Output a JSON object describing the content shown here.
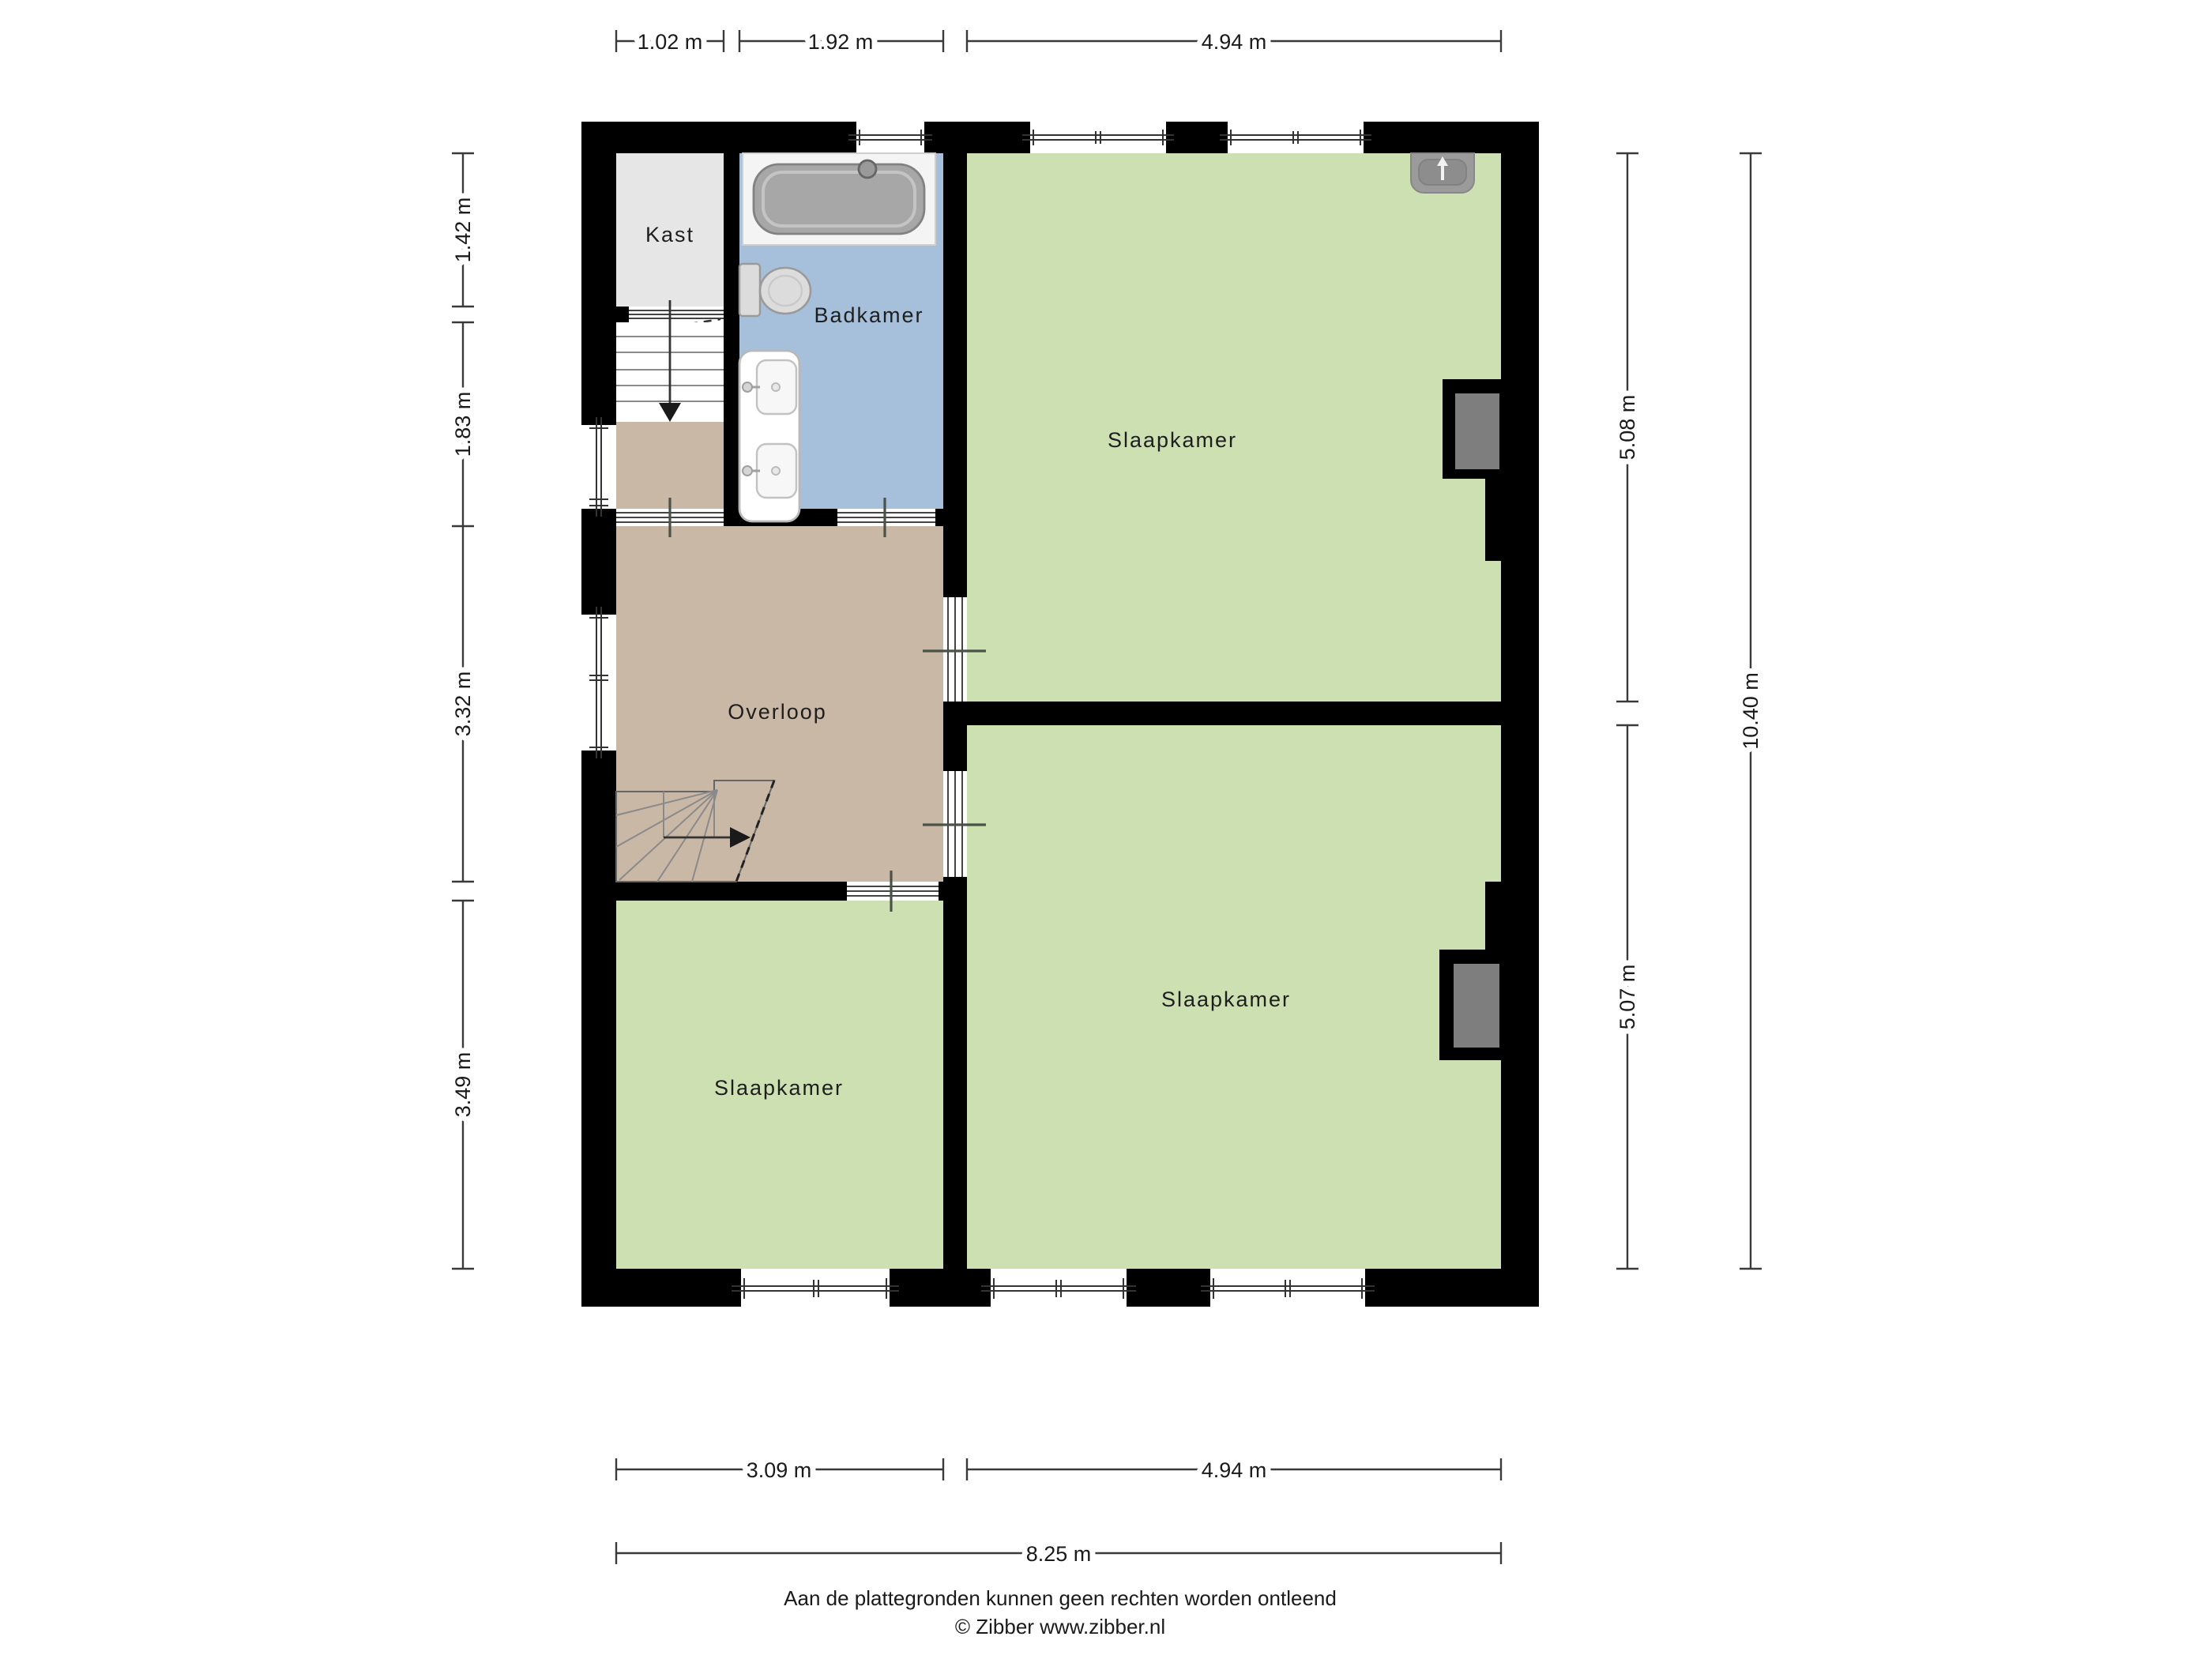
{
  "rooms": {
    "kast": "Kast",
    "badkamer": "Badkamer",
    "overloop": "Overloop",
    "slaapkamer_top": "Slaapkamer",
    "slaapkamer_bottom_right": "Slaapkamer",
    "slaapkamer_bottom_left": "Slaapkamer"
  },
  "dimensions": {
    "top": [
      "1.02 m",
      "1.92 m",
      "4.94 m"
    ],
    "left": [
      "1.42 m",
      "1.83 m",
      "3.32 m",
      "3.49 m"
    ],
    "right": [
      "5.08 m",
      "5.07 m"
    ],
    "right_total": "10.40 m",
    "bottom": [
      "3.09 m",
      "4.94 m"
    ],
    "bottom_total": "8.25 m"
  },
  "footer": {
    "line1": "Aan de plattegronden kunnen geen rechten worden ontleend",
    "line2": "© Zibber www.zibber.nl"
  },
  "colors": {
    "wall": "#000000",
    "room_green": "#cde0b2",
    "bathroom_blue": "#a6c0dc",
    "hall_tan": "#c9b8a5",
    "closet_gray": "#e6e6e6",
    "chimney_gray": "#7e7e7e",
    "fixture_gray": "#dcdcdc",
    "tub_gray": "#a7a7a7"
  }
}
